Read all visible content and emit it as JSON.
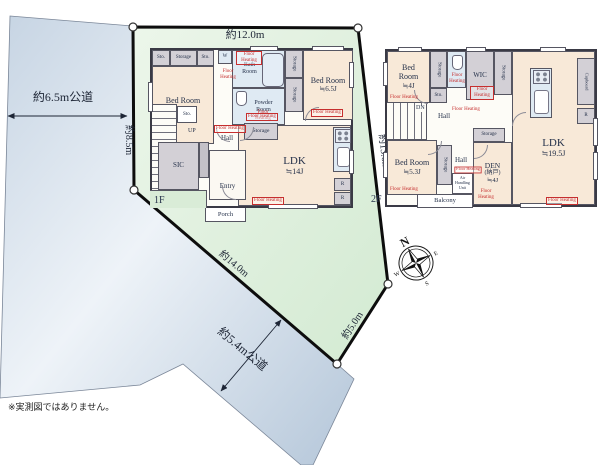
{
  "colors": {
    "plot_green": "#d9ecd7",
    "road_blue": "#c6d4e3",
    "heating_red": "#c62f2f",
    "label_navy": "#25314a"
  },
  "note": "※実測図ではありません。",
  "site": {
    "dim_top": "約12.0m",
    "dim_left": "約8.5m",
    "dim_right": "約13.6m",
    "dim_bottom": "約14.0m",
    "dim_bottom_right": "約5.0m",
    "road_left": "約6.5m公道",
    "road_bottom": "約5.4m公道"
  },
  "compass": {
    "n": "N",
    "e": "E",
    "s": "S",
    "w": "W"
  },
  "fh": "Floor Heating",
  "f1": {
    "label": "1F",
    "sto_a": "Sto.",
    "storage_a": "Storage",
    "sto_b": "Sto.",
    "w": "W",
    "bath": {
      "name": "Bath Room"
    },
    "bed1": {
      "name": "Bed Room",
      "size": "≒4.5J"
    },
    "storage_v1": "Storage",
    "storage_v2": "Storage",
    "bed2": {
      "name": "Bed Room",
      "size": "≒6.5J"
    },
    "powder": {
      "name": "Powder Room"
    },
    "sto_c": "Sto.",
    "up": "UP",
    "hall": "Hall",
    "storage_b": "Storage",
    "sic": "SIC",
    "entry": "Entry",
    "porch": "Porch",
    "ldk": {
      "name": "LDK",
      "size": "≒14J"
    },
    "r1": "R",
    "r2": "R"
  },
  "f2": {
    "label": "2F",
    "bed1": {
      "name": "Bed Room",
      "size": "≒4J"
    },
    "storage_v1": "Storage",
    "sto_a": "Sto.",
    "wic": "WIC",
    "storage_v2": "Storage",
    "cupboard": "Cupboard",
    "r1": "R",
    "dn": "DN",
    "hall1": "Hall",
    "hall2": "Hall",
    "ahu": {
      "l1": "Air",
      "l2": "Handling",
      "l3": "Unit"
    },
    "storage_mid": "Storage",
    "den": {
      "name": "DEN",
      "name2": "(納戸)",
      "size": "≒4J"
    },
    "storage_v3": "Storage",
    "bed2": {
      "name": "Bed Room",
      "size": "≒5.3J"
    },
    "balcony": "Balcony",
    "ldk": {
      "name": "LDK",
      "size": "≒19.5J"
    }
  }
}
